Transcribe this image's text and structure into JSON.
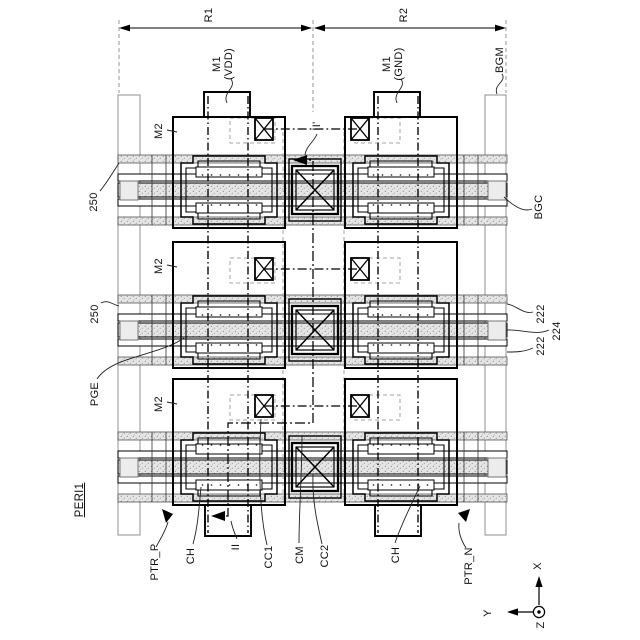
{
  "figure": {
    "dimensions": {
      "r1": "R1",
      "r2": "R2"
    },
    "labels": {
      "m1": "M1",
      "vdd": "(VDD)",
      "gnd": "(GND)",
      "bgm": "BGM",
      "bgc": "BGC",
      "m2": "M2",
      "rail250": "250",
      "pge": "PGE",
      "peri1": "PERI1",
      "n222": "222",
      "n224": "224",
      "ptr_p": "PTR_P",
      "ptr_n": "PTR_N",
      "ch": "CH",
      "section_ii": "II",
      "section_ii_prime": "II'",
      "cc1": "CC1",
      "cm": "CM",
      "cc2": "CC2"
    },
    "axes": {
      "x": "X",
      "y": "Y",
      "z": "Z"
    }
  }
}
